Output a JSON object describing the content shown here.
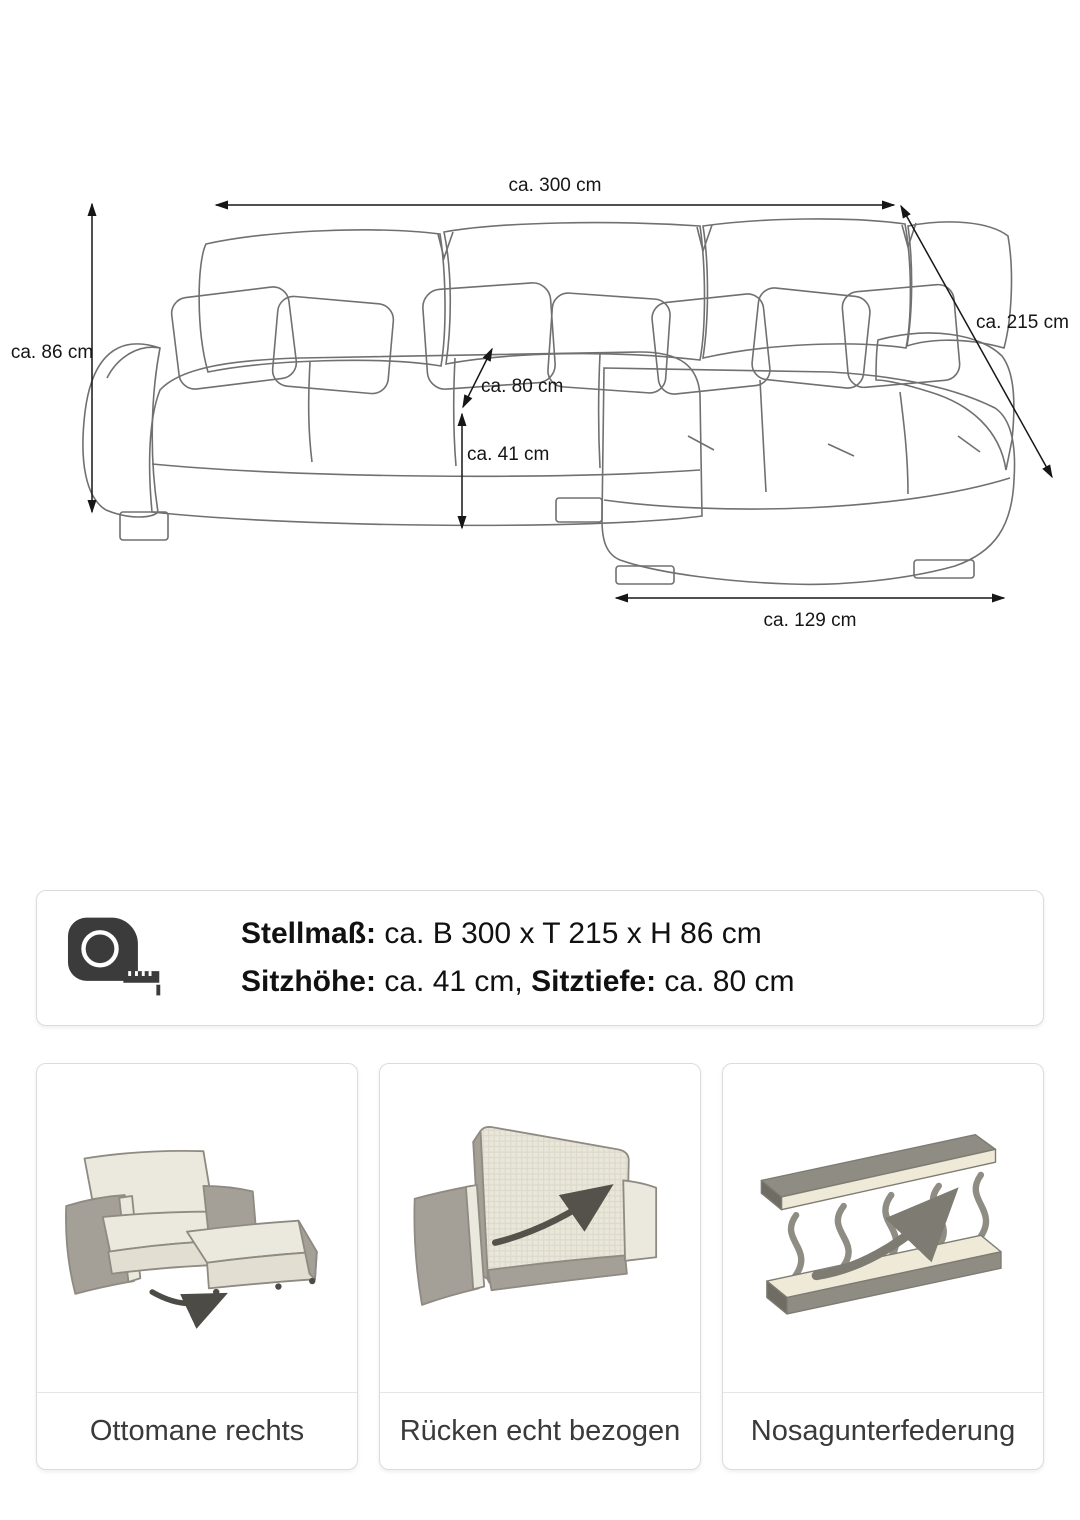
{
  "diagram": {
    "dim_width": "ca. 300 cm",
    "dim_depth": "ca. 215 cm",
    "dim_height": "ca. 86 cm",
    "dim_seat_depth": "ca. 80 cm",
    "dim_seat_height": "ca. 41 cm",
    "dim_ottoman_width": "ca. 129 cm"
  },
  "info_box": {
    "icon": "tape-measure-icon",
    "line1_label": "Stellmaß:",
    "line1_value": " ca. B 300 x T 215 x H 86 cm",
    "line2_label1": "Sitzhöhe:",
    "line2_value1": " ca. 41 cm, ",
    "line2_label2": "Sitztiefe:",
    "line2_value2": " ca. 80 cm"
  },
  "cards": [
    {
      "icon": "ottoman-right-illustration",
      "label": "Ottomane rechts"
    },
    {
      "icon": "sofa-back-covered-illustration",
      "label": "Rücken echt bezogen"
    },
    {
      "icon": "nosag-springs-illustration",
      "label": "Nosagunterfederung"
    }
  ],
  "colors": {
    "dimension_lines": "#161616",
    "sketch_outline": "#707070",
    "illustration_gray": "#a49f97",
    "illustration_cream": "#ebe8dd",
    "arrow_dark": "#4d4b46"
  }
}
